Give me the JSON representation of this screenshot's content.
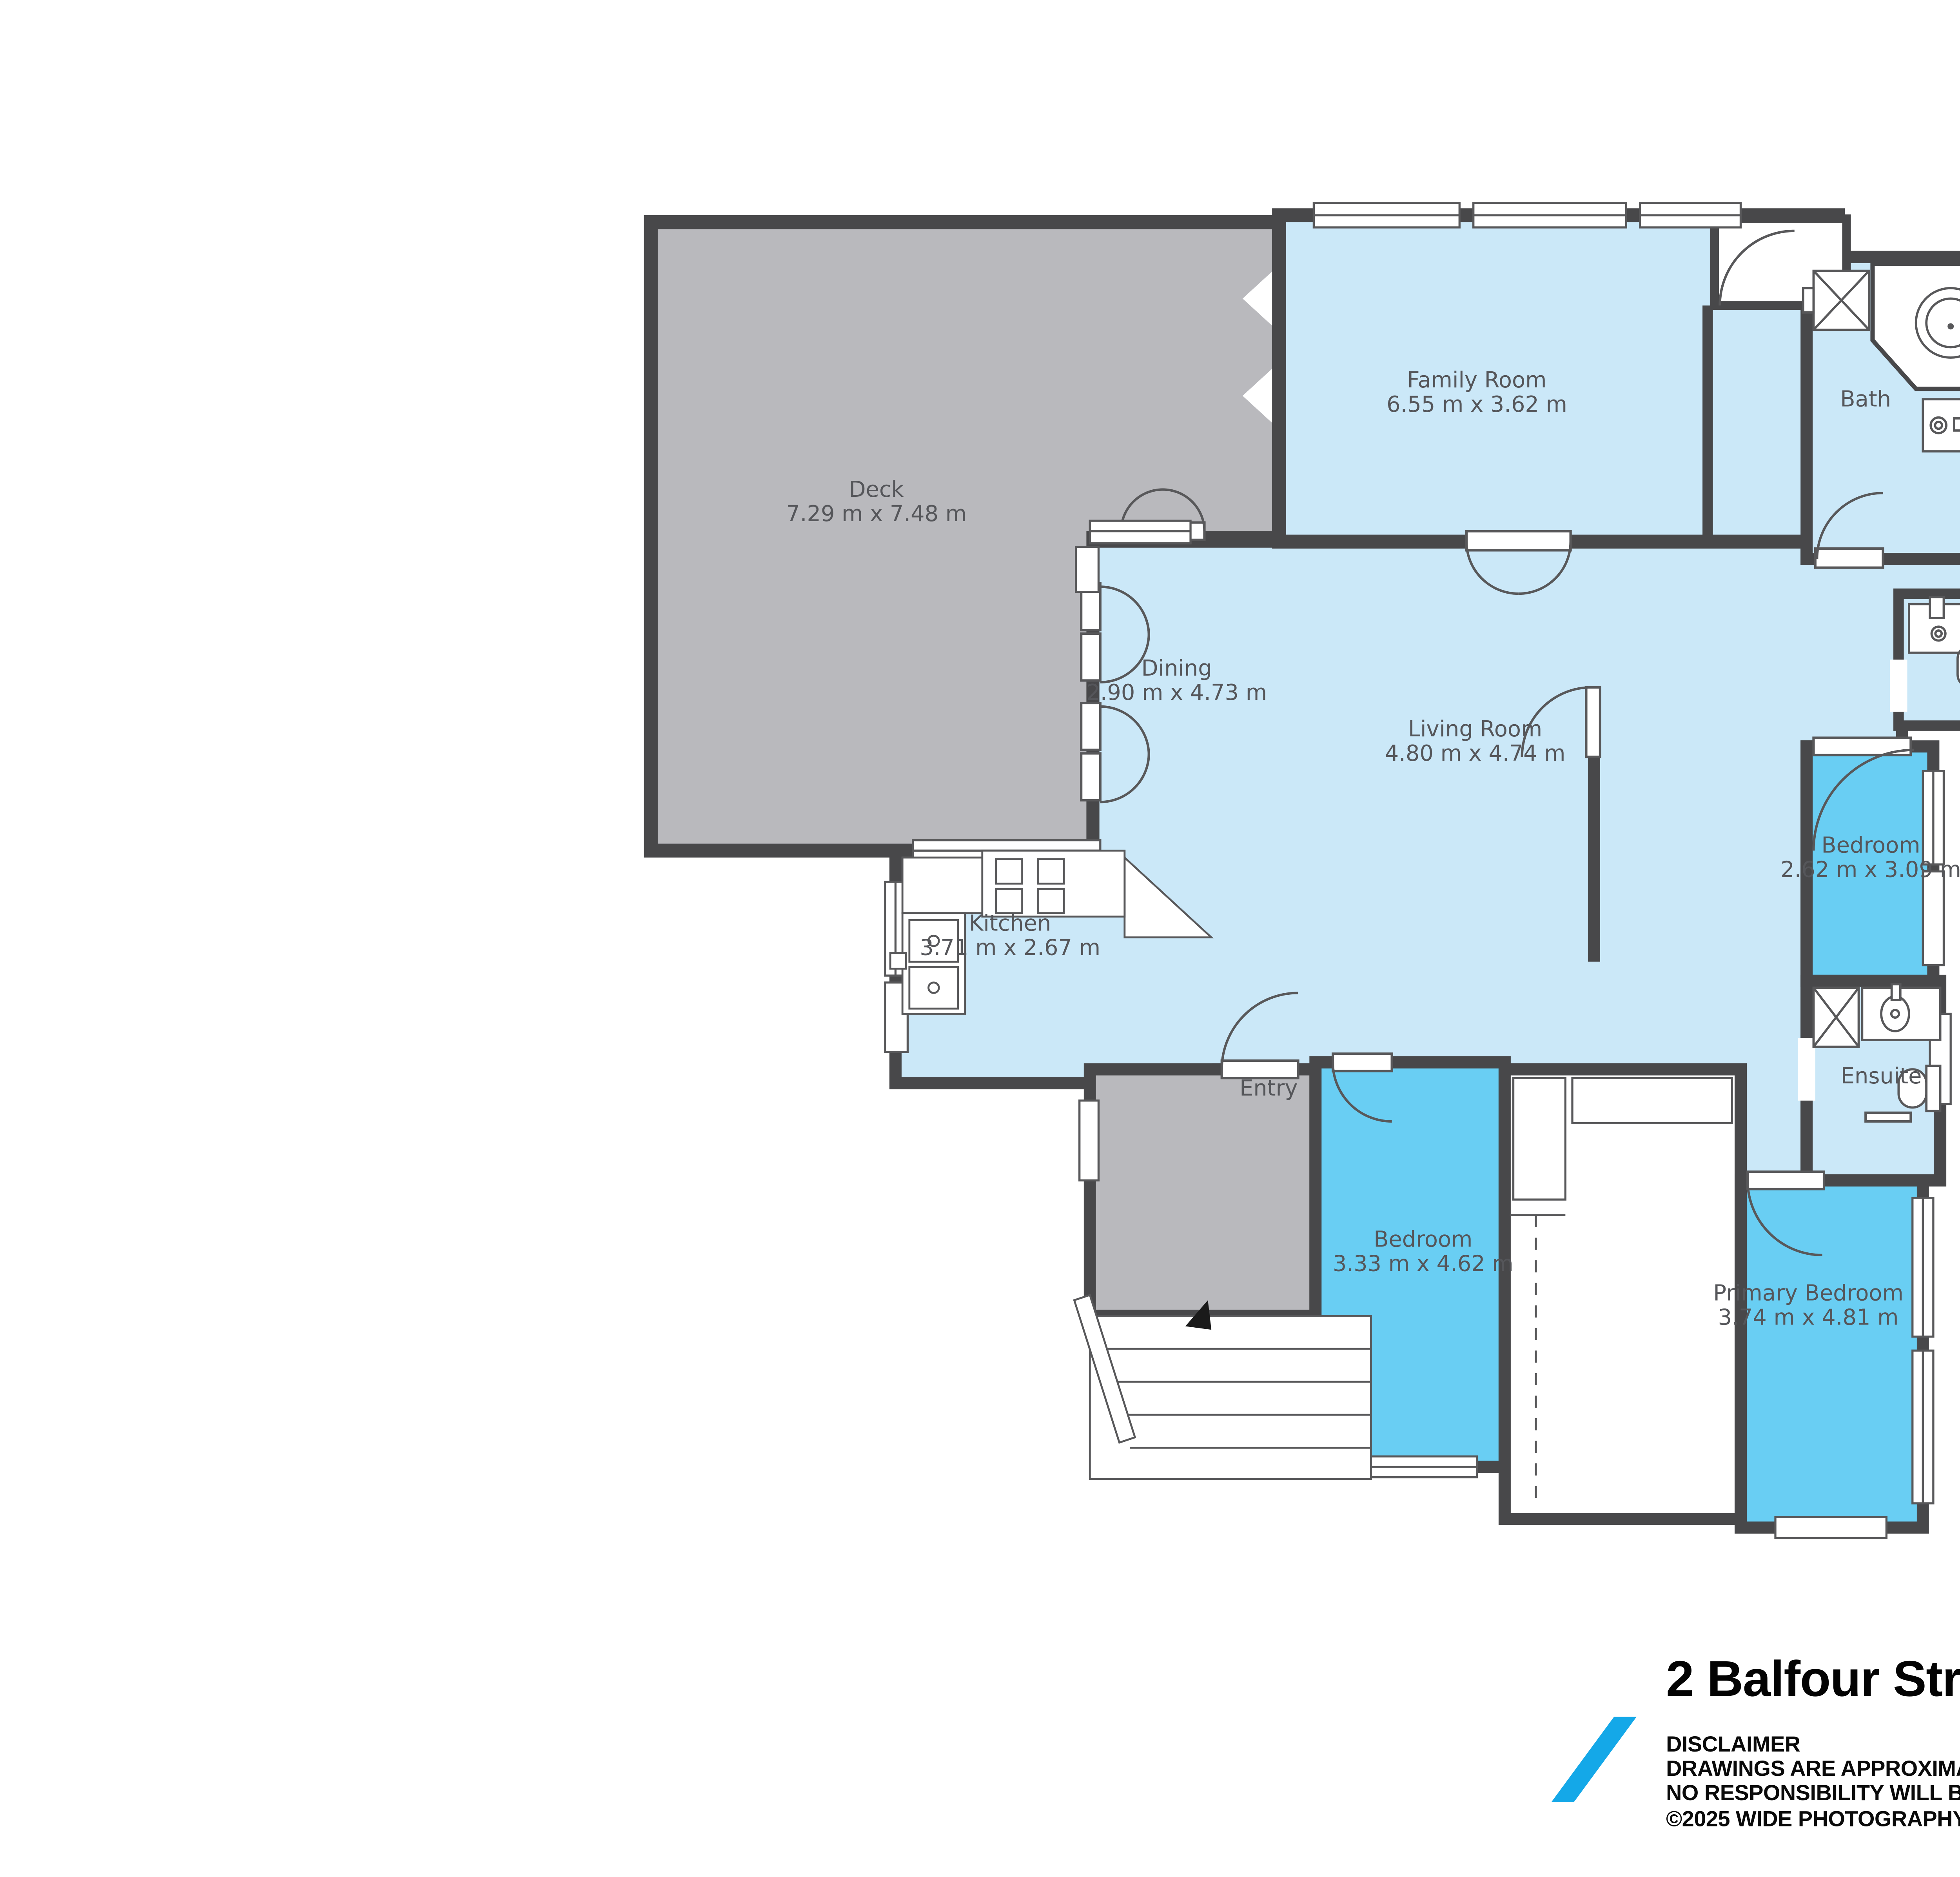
{
  "compass": {
    "label": "N"
  },
  "rooms": {
    "deck": {
      "name": "Deck",
      "dims": "7.29 m x 7.48 m"
    },
    "family_room": {
      "name": "Family Room",
      "dims": "6.55 m x 3.62 m"
    },
    "bath": {
      "name": "Bath"
    },
    "dining": {
      "name": "Dining",
      "dims": "2.90 m x 4.73 m"
    },
    "living_room": {
      "name": "Living Room",
      "dims": "4.80 m x 4.74 m"
    },
    "kitchen": {
      "name": "Kitchen",
      "dims": "3.71 m x 2.67 m"
    },
    "entry": {
      "name": "Entry"
    },
    "bedroom_small": {
      "name": "Bedroom",
      "dims": "2.62 m x 3.09 m"
    },
    "ensuite": {
      "name": "Ensuite"
    },
    "bedroom_second": {
      "name": "Bedroom",
      "dims": "3.33 m x 4.62 m"
    },
    "primary_bedroom": {
      "name": "Primary Bedroom",
      "dims": "3.74 m x 4.81 m"
    }
  },
  "footer": {
    "title": "2 Balfour Street, Bayswater",
    "disclaimer_heading": "DISCLAIMER",
    "disclaimer_line1": "DRAWINGS ARE APPROXIMATE AND FOR ILLUSTRATION PURPOSES ONLY",
    "disclaimer_line2": "NO RESPONSIBILITY WILL BE TAKEN FOR ANY OMISSIONS AND ERRORS.",
    "copyright": "©2025 WIDE PHOTOGRAPHY"
  },
  "colors": {
    "wall": "#48484a",
    "room_light_blue": "#cbe8f8",
    "room_dark_blue": "#69cef3",
    "deck_gray": "#b9b9bd",
    "fixture_line": "#58585a",
    "label_text": "#55565a",
    "logo_blue": "#14a8e8",
    "compass_gray": "#8b8b8e"
  }
}
